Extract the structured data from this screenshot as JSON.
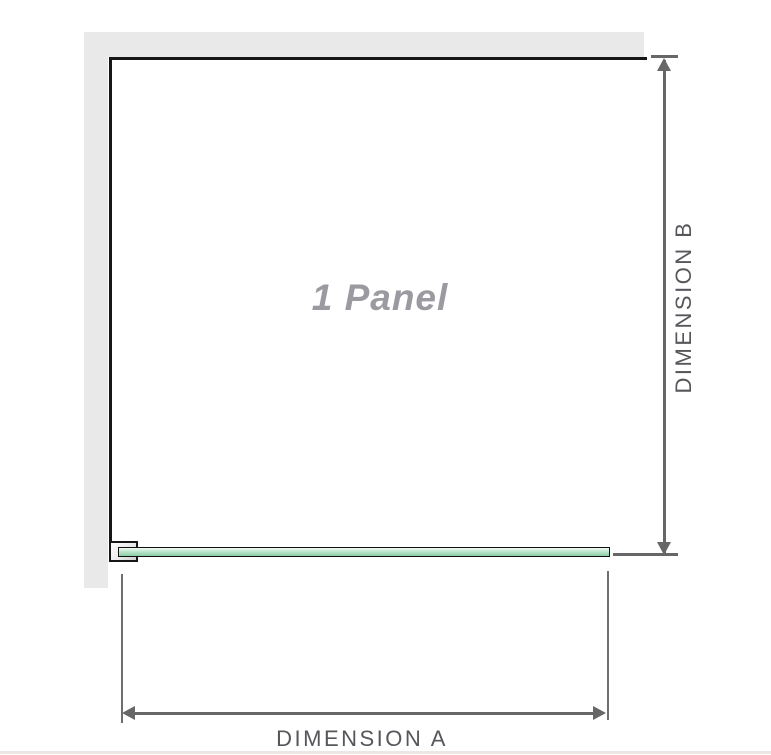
{
  "diagram": {
    "panel_label": "1 Panel",
    "dimensions": {
      "a_label": "DIMENSION A",
      "b_label": "DIMENSION B"
    },
    "colors": {
      "wall_gray": "#e9e9e9",
      "outline_black": "#161616",
      "dimension_gray": "#676767",
      "label_gray": "#56575b",
      "panel_label_gray": "#9a9aa0",
      "glass_green_light": "#f2faf5",
      "glass_green": "#a8dcbc",
      "glass_green_dark": "#8bcda5"
    }
  }
}
